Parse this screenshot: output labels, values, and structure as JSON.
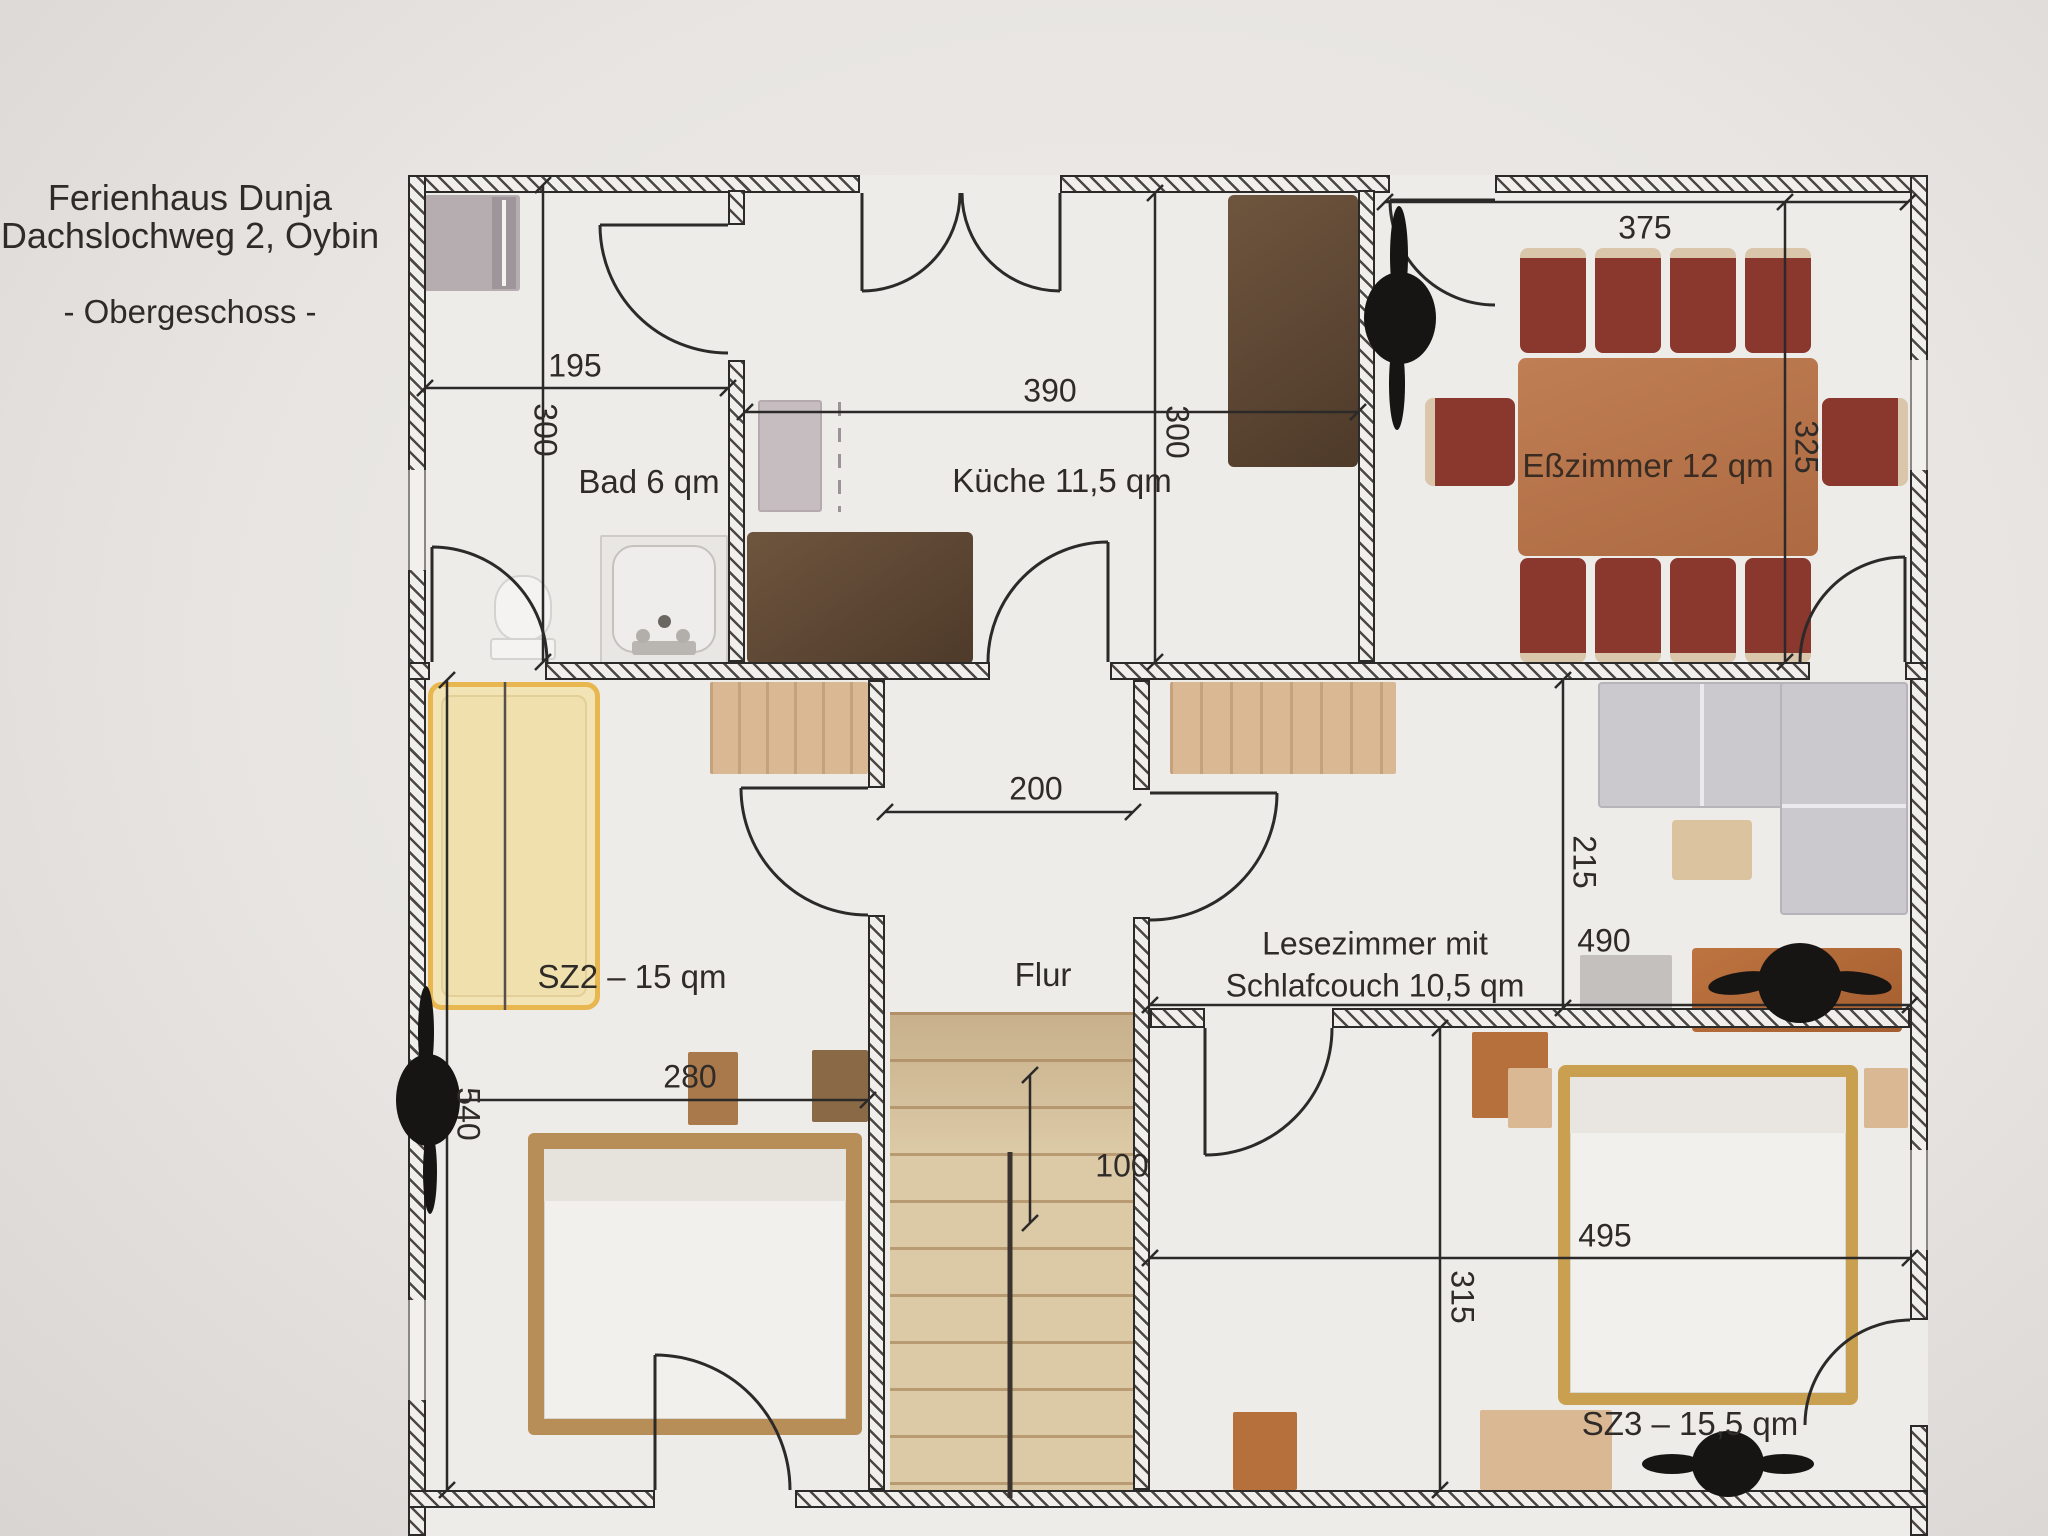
{
  "header": {
    "line1": "Ferienhaus Dunja",
    "line2": "Dachslochweg 2, Oybin",
    "line3": "- Obergeschoss -"
  },
  "rooms": {
    "bad": {
      "label": "Bad 6 qm",
      "width_cm": "195",
      "height_cm": "300"
    },
    "kueche": {
      "label": "Küche 11,5 qm",
      "width_cm": "390",
      "height_cm": "300"
    },
    "esszimmer": {
      "label": "Eßzimmer 12 qm",
      "width_cm": "375",
      "height_cm": "325"
    },
    "flur": {
      "label": "Flur",
      "width_cm": "200",
      "stair_cm": "100"
    },
    "sz2": {
      "label": "SZ2 – 15 qm",
      "width_cm": "280",
      "height_cm": "540"
    },
    "lesezimmer": {
      "label_line1": "Lesezimmer mit",
      "label_line2": "Schlafcouch 10,5 qm",
      "width_cm": "490",
      "height_cm": "215"
    },
    "sz3": {
      "label": "SZ3 – 15,5 qm",
      "width_cm": "495",
      "height_cm": "315"
    }
  },
  "colors": {
    "paper": "#e8e5e2",
    "wall_line": "#2c2a28",
    "counter_dark_brown": "#5f4936",
    "table_wood": "#b9734a",
    "chair_red": "#8a372d",
    "bed_yellow": "#f0e0ae",
    "bed_yellow_border": "#e9b750",
    "wood_tan": "#d9b893",
    "stairs_tan": "#dcc9a6",
    "sofa_gray": "#ccc9ce",
    "text": "#2e2b28"
  }
}
